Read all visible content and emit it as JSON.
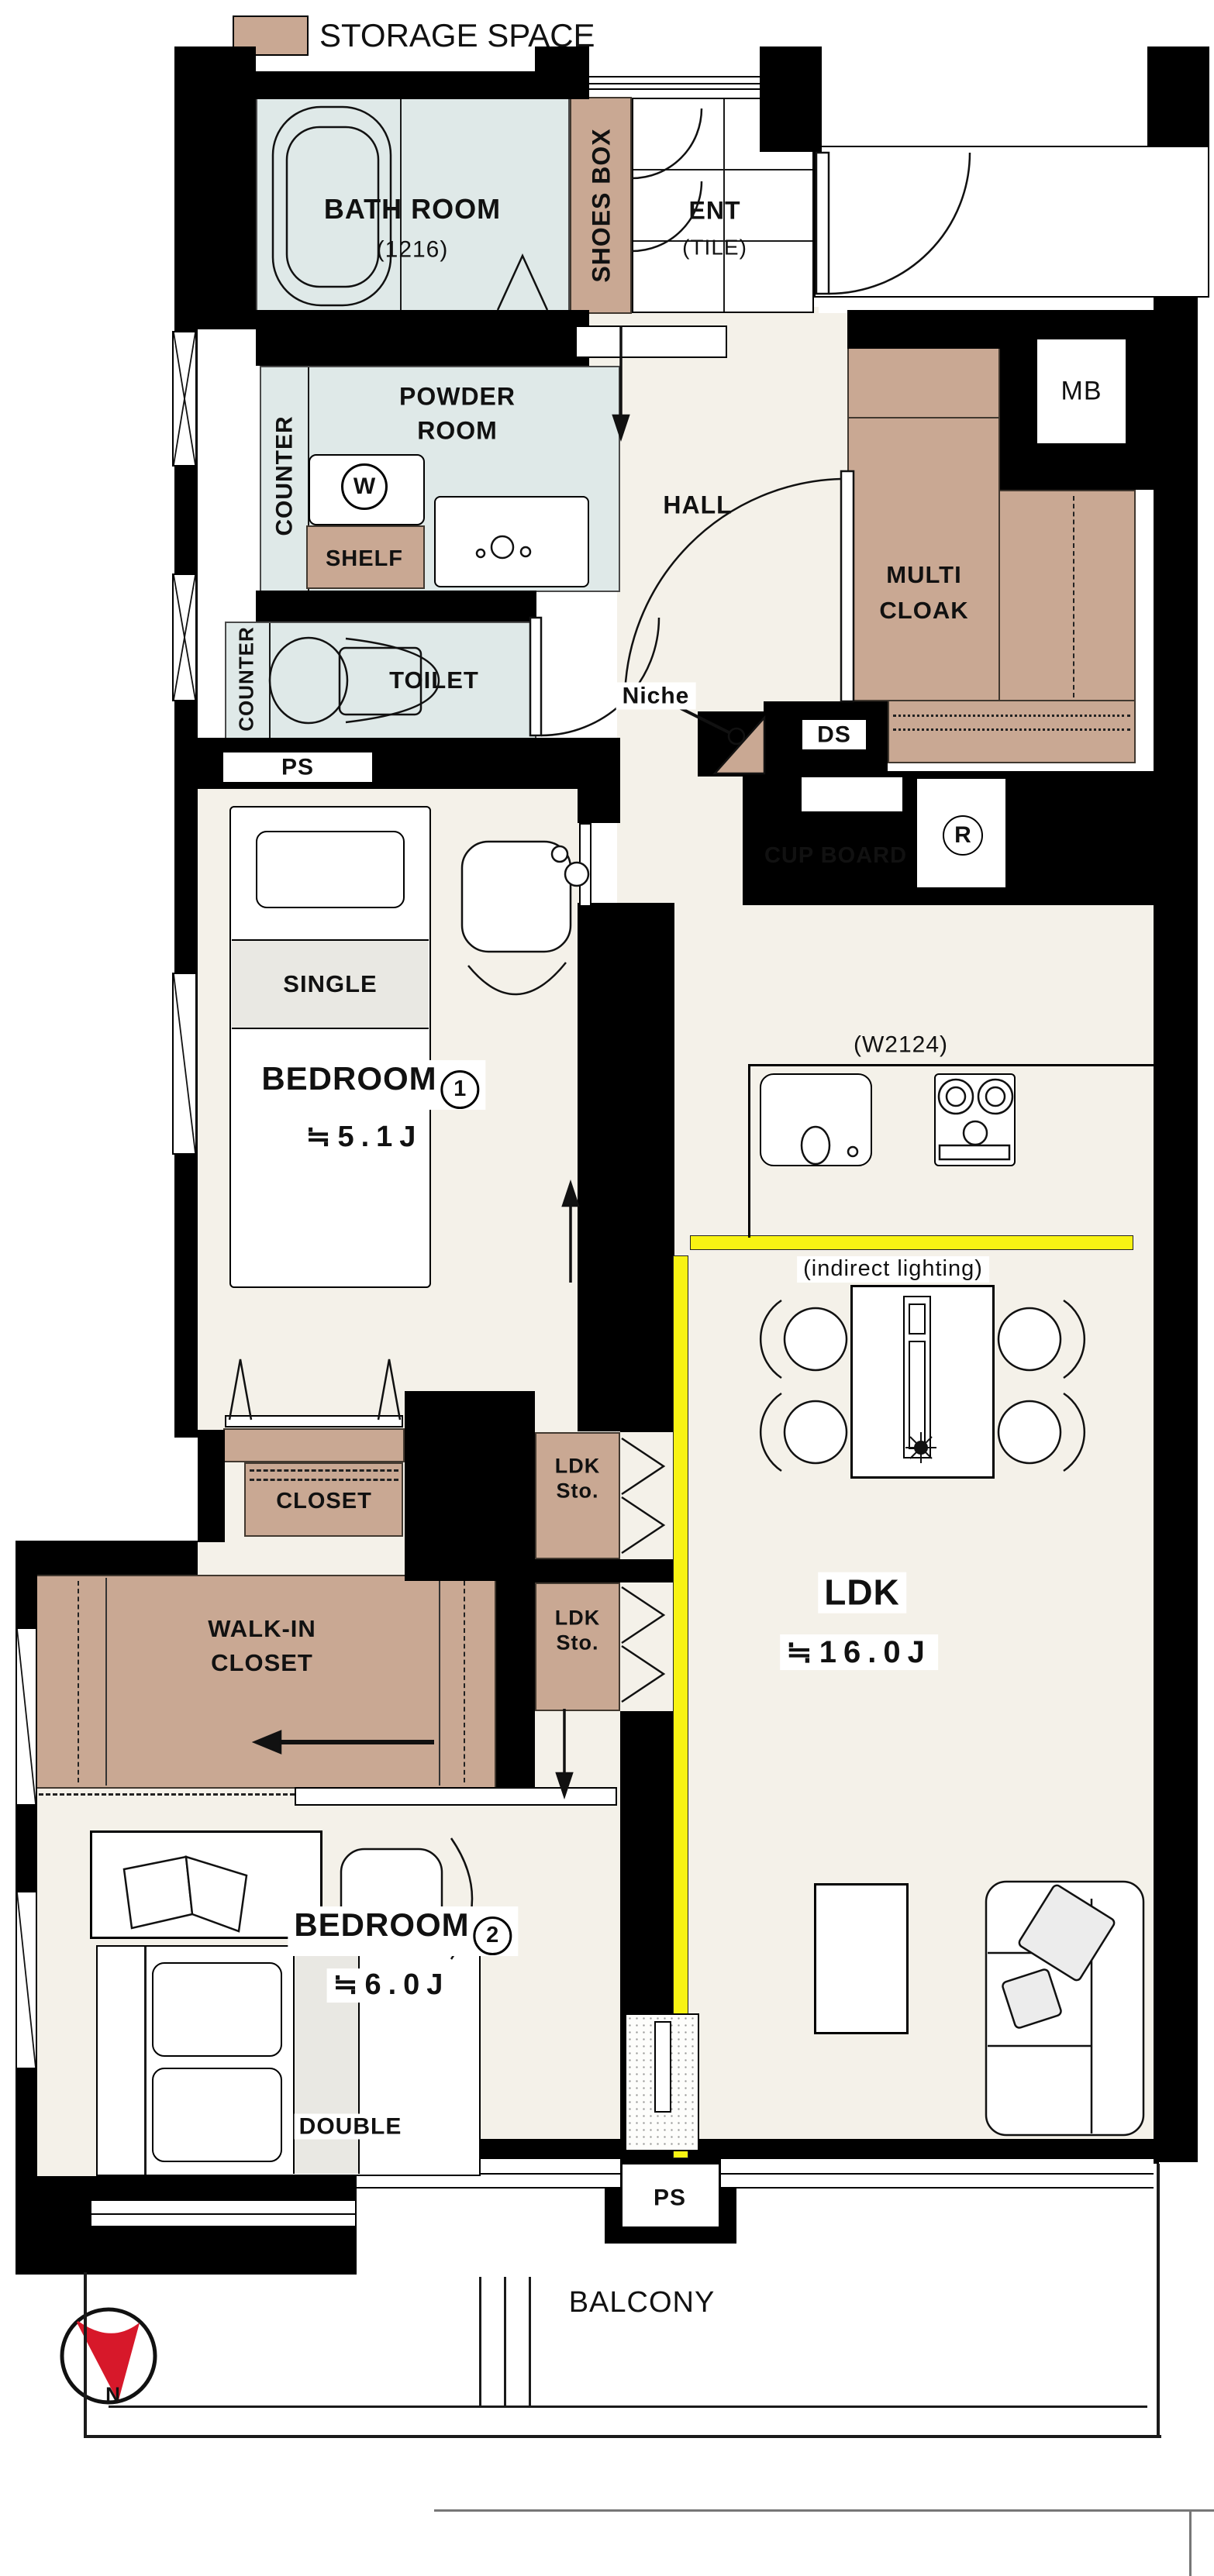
{
  "legend": {
    "label": "STORAGE SPACE",
    "swatch_color": "#c9a893"
  },
  "colors": {
    "storage": "#c9a893",
    "wet_room": "#dfe9e8",
    "floor": "#f4f1e9",
    "wall": "#000000",
    "indirect_lighting": "#f8f313",
    "compass_needle": "#d7182a"
  },
  "wet_area": {
    "bathroom": {
      "name": "BATH ROOM",
      "size": "(1216)"
    },
    "powder_room": {
      "line1": "POWDER",
      "line2": "ROOM"
    },
    "counter_powder": "COUNTER",
    "counter_toilet": "COUNTER",
    "shelf": "SHELF",
    "washer_symbol": "W",
    "toilet": "TOILET",
    "ps_top": "PS"
  },
  "entrance": {
    "shoes_box": "SHOES BOX",
    "name": "ENT",
    "floor": "(TILE)",
    "hall": "HALL",
    "niche": "Niche",
    "multi_cloak": {
      "line1": "MULTI",
      "line2": "CLOAK"
    },
    "mb": "MB",
    "ds": "DS"
  },
  "kitchen": {
    "cupboard": "CUP BOARD",
    "fridge_symbol": "R",
    "width_note": "(W2124)",
    "indirect_note": "(indirect lighting)"
  },
  "ldk": {
    "name": "LDK",
    "area": "≒16.0J",
    "sto1": "LDK Sto.",
    "sto2": "LDK Sto.",
    "ps_bottom": "PS"
  },
  "bedroom1": {
    "name": "BEDROOM",
    "number": "1",
    "area": "≒5.1J",
    "bed": "SINGLE",
    "closet": "CLOSET"
  },
  "bedroom2": {
    "name": "BEDROOM",
    "number": "2",
    "area": "≒6.0J",
    "bed": "DOUBLE",
    "wic_line1": "WALK-IN",
    "wic_line2": "CLOSET"
  },
  "outdoor": {
    "balcony": "BALCONY",
    "compass_north": "N"
  }
}
